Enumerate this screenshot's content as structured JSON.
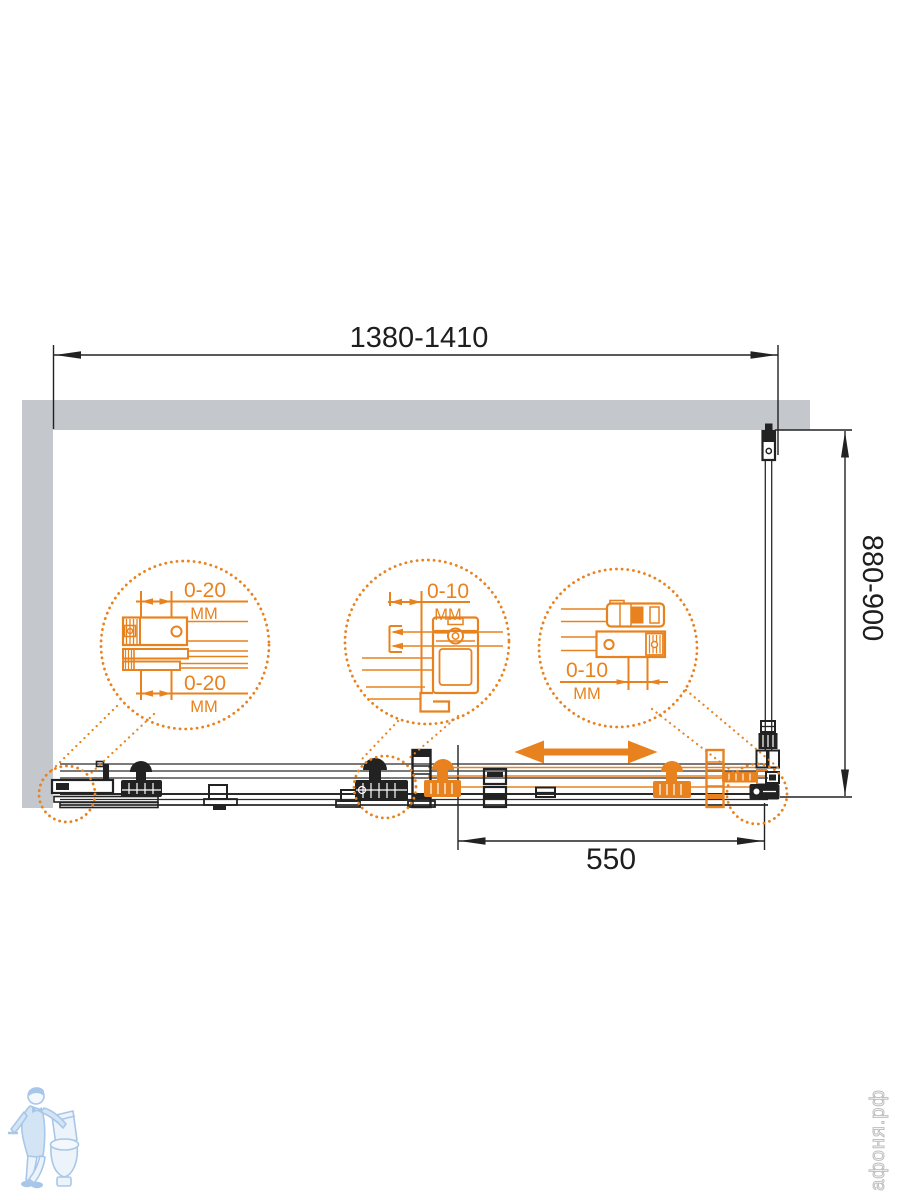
{
  "drawing": {
    "dimensions": {
      "width_total": "1380-1410",
      "height_side": "880-900",
      "door_width": "550"
    },
    "callouts": {
      "wall_profile": {
        "top_value": "0-20",
        "top_unit": "ММ",
        "bottom_value": "0-20",
        "bottom_unit": "ММ"
      },
      "door_roller": {
        "value": "0-10",
        "unit": "ММ"
      },
      "corner_bracket": {
        "value": "0-10",
        "unit": "ММ"
      }
    },
    "watermark": {
      "brand": "афоня.рф"
    },
    "colors": {
      "accent_orange": "#E8821E",
      "wall_gray": "#C4C7CB",
      "line_black": "#222222",
      "mascot_blue": "#9FC2E6",
      "brand_gray": "#BFBFBF"
    }
  }
}
